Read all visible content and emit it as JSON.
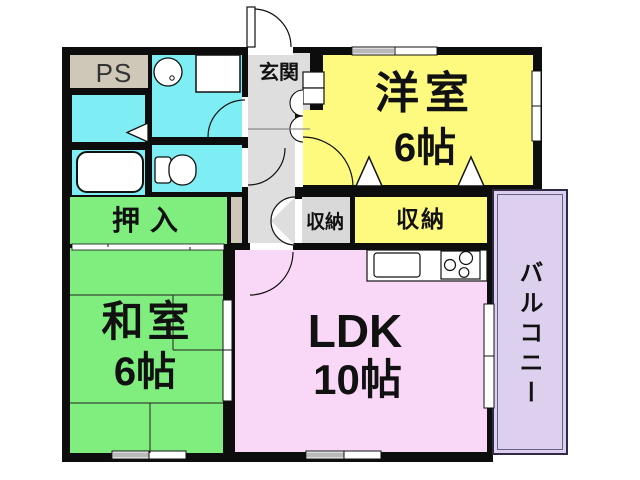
{
  "rooms": {
    "ps": {
      "label": "PS"
    },
    "entrance": {
      "label": "玄関"
    },
    "western_room": {
      "label": "洋室",
      "size": "6帖"
    },
    "storage_hall": {
      "label": "収納"
    },
    "storage_west": {
      "label": "収納"
    },
    "closet": {
      "label": "押入"
    },
    "japanese_room": {
      "label": "和室",
      "size": "6帖"
    },
    "ldk": {
      "label": "LDK",
      "size": "10帖"
    },
    "balcony": {
      "label": "バルコニー"
    }
  },
  "colors": {
    "wall": "#0d0d0d",
    "western_room_fill": "#fdfa7f",
    "wet_area_fill": "#7eeef4",
    "tatami_fill": "#7fee7f",
    "ldk_fill": "#f9d7f7",
    "balcony_fill": "#dcd0ee",
    "hall_fill": "#dedede",
    "storage_gray_fill": "#d9d9d9",
    "ps_fill": "#cfc8b9",
    "window_pane_gray": "#b9b9b9"
  }
}
